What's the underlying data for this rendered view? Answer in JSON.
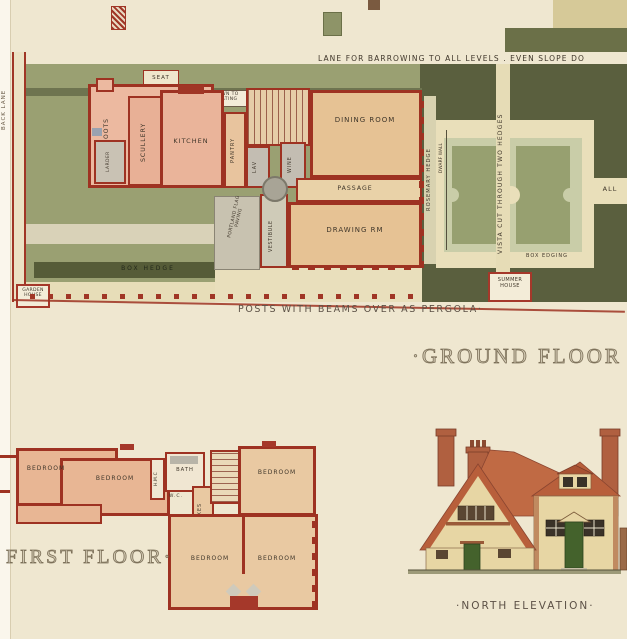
{
  "colors": {
    "paper": "#efe7d0",
    "wall_red": "#9e3222",
    "lawn_olive": "#9aa072",
    "hedge_dark": "#5a5f3e",
    "box_hedge_dark": "#3f442c",
    "path_cream": "#e9dfba",
    "room_pink": "#ecb9a0",
    "room_peach": "#e6c294",
    "paving_grey": "#c3bdb2",
    "roof_red": "#c06a44",
    "elevation_wall": "#e7d6a4",
    "door_green": "#44622c"
  },
  "ground": {
    "lane_caption": "LANE FOR BARROWING TO ALL LEVELS . EVEN SLOPE DO",
    "back_lane": "BACK LANE",
    "seat": "SEAT",
    "down_to_heating": "DOWN TO HEATING",
    "boots": "BOOTS",
    "larder": "LARDER",
    "scullery": "SCULLERY",
    "kitchen": "KITCHEN",
    "pantry": "PANTRY",
    "lav": "LAV",
    "wine": "WINE",
    "dining_room": "DINING ROOM",
    "passage": "PASSAGE",
    "drawing_room": "DRAWING RM",
    "vestibule": "VESTIBULE",
    "portland_paving": "PORTLAND FLAG PAVING",
    "box_hedge": "BOX HEDGE",
    "garden_house": "GARDEN HOUSE",
    "rosemary_hedge": "ROSEMARY HEDGE",
    "vista": "VISTA CUT THROUGH TWO HEDGES",
    "dwarf_wall": "DWARF WALL",
    "all": "ALL",
    "box_edging": "BOX EDGING",
    "summer_house": "SUMMER HOUSE",
    "pergola_caption": "POSTS WITH BEAMS OVER AS PERGOLA·",
    "title": "·GROUND FLOOR AN"
  },
  "first": {
    "bedroom_left": "BEDROOM",
    "bedroom_center": "BEDROOM",
    "hmc": "H.M.C",
    "bath": "BATH",
    "wc": "W.C.",
    "boxes": "BOXES",
    "bedroom_right": "BEDROOM",
    "bedroom_bottom_left": "BEDROOM",
    "bedroom_bottom_right": "BEDROOM",
    "title": "FIRST FLOOR·"
  },
  "elevation": {
    "caption": "·NORTH ELEVATION·"
  }
}
